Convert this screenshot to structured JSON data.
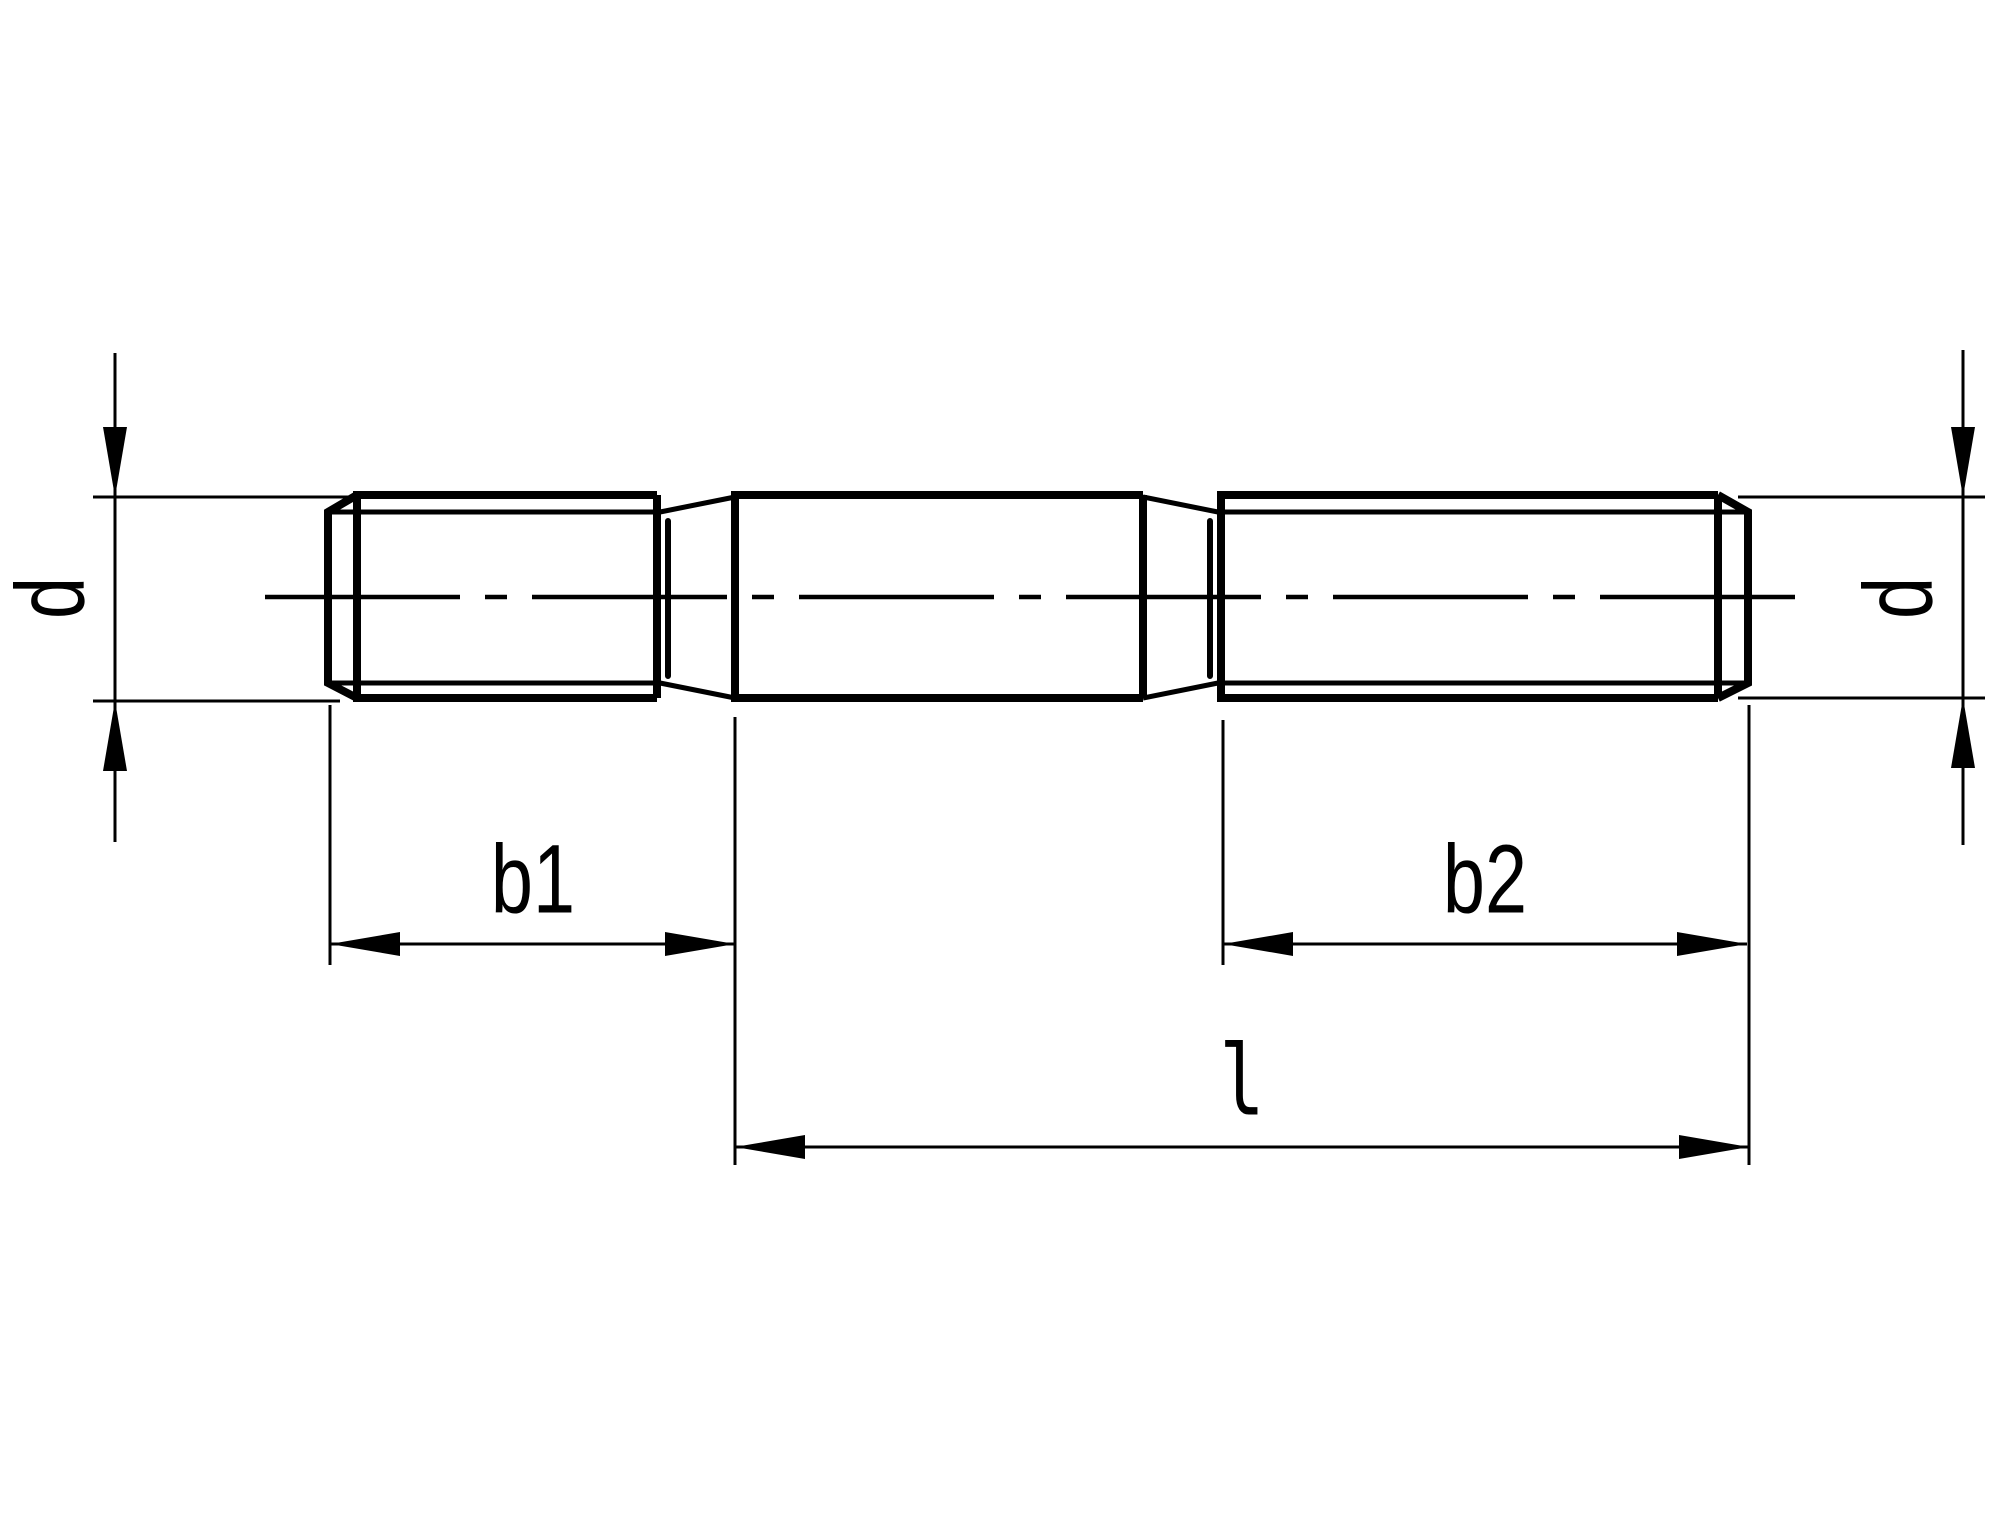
{
  "drawing": {
    "background_color": "#ffffff",
    "line_color": "#000000",
    "labels": {
      "diameter_left": "d",
      "diameter_right": "d",
      "thread_length_left": "b1",
      "thread_length_right": "b2",
      "overall_length": "l"
    }
  }
}
